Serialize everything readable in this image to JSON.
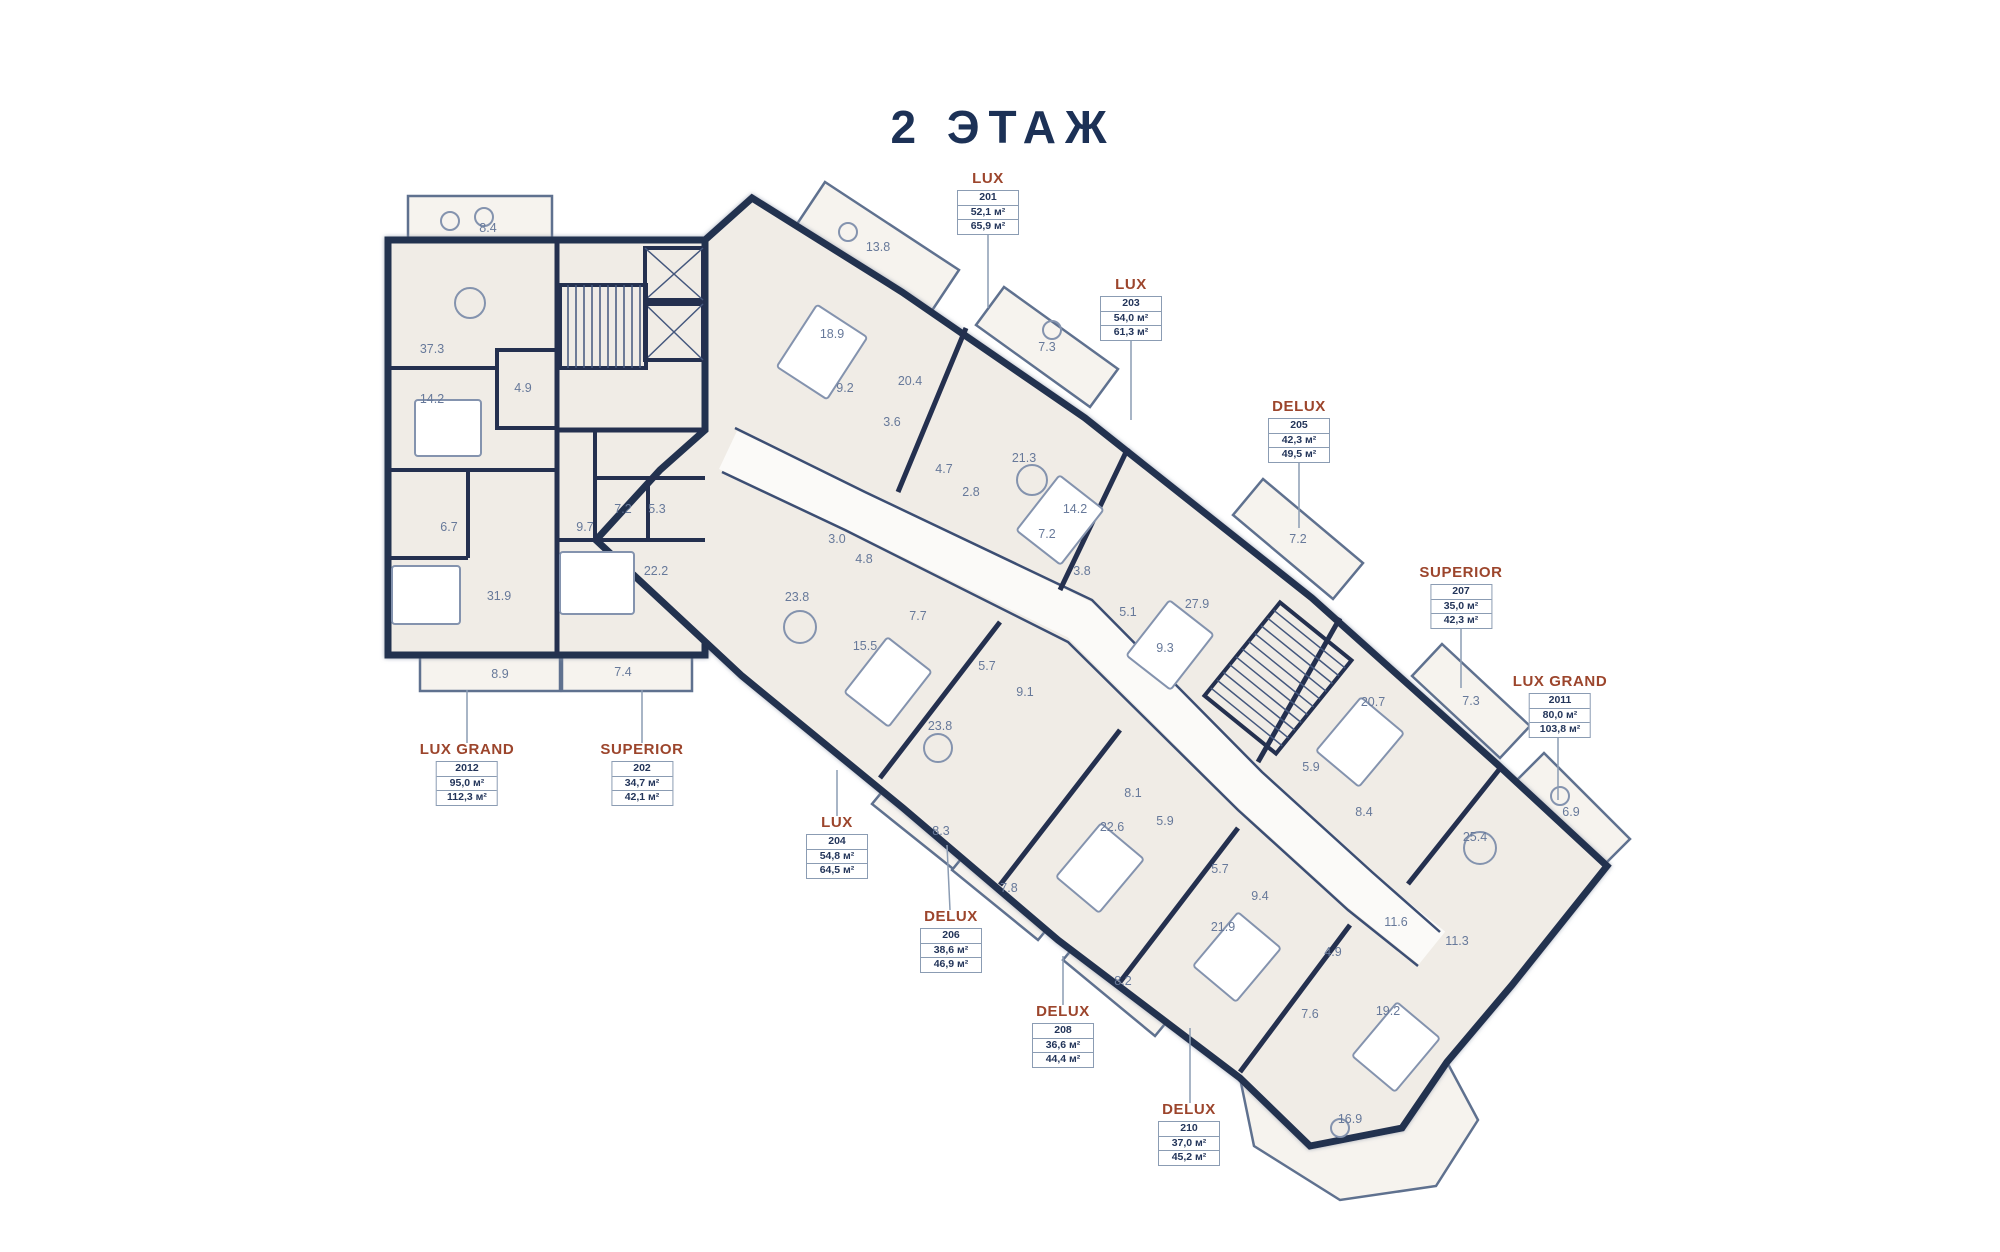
{
  "title": "2 ЭТАЖ",
  "colors": {
    "wall": "#24304f",
    "room_fill": "#f0ece6",
    "unit_type_accent": "#9c452c",
    "annotation": "#67799a",
    "box_border": "#8b9cb3",
    "box_text": "#23355a",
    "title_text": "#1c3156"
  },
  "units": [
    {
      "type": "LUX",
      "number": "201",
      "area1": "52,1 м²",
      "area2": "65,9 м²",
      "x": 988,
      "y": 170,
      "leader": [
        988,
        228,
        988,
        308
      ]
    },
    {
      "type": "LUX",
      "number": "203",
      "area1": "54,0 м²",
      "area2": "61,3 м²",
      "x": 1131,
      "y": 276,
      "leader": [
        1131,
        334,
        1131,
        420
      ]
    },
    {
      "type": "DELUX",
      "number": "205",
      "area1": "42,3 м²",
      "area2": "49,5 м²",
      "x": 1299,
      "y": 398,
      "leader": [
        1299,
        456,
        1299,
        528
      ]
    },
    {
      "type": "SUPERIOR",
      "number": "207",
      "area1": "35,0 м²",
      "area2": "42,3 м²",
      "x": 1461,
      "y": 564,
      "leader": [
        1461,
        622,
        1461,
        688
      ]
    },
    {
      "type": "LUX GRAND",
      "number": "2011",
      "area1": "80,0 м²",
      "area2": "103,8 м²",
      "x": 1560,
      "y": 673,
      "leader": [
        1558,
        731,
        1558,
        800
      ]
    },
    {
      "type": "LUX GRAND",
      "number": "2012",
      "area1": "95,0 м²",
      "area2": "112,3 м²",
      "x": 467,
      "y": 741,
      "leader": [
        467,
        690,
        467,
        743
      ]
    },
    {
      "type": "SUPERIOR",
      "number": "202",
      "area1": "34,7 м²",
      "area2": "42,1 м²",
      "x": 642,
      "y": 741,
      "leader": [
        642,
        690,
        642,
        743
      ]
    },
    {
      "type": "LUX",
      "number": "204",
      "area1": "54,8 м²",
      "area2": "64,5 м²",
      "x": 837,
      "y": 814,
      "leader": [
        837,
        770,
        837,
        816
      ]
    },
    {
      "type": "DELUX",
      "number": "206",
      "area1": "38,6 м²",
      "area2": "46,9 м²",
      "x": 951,
      "y": 908,
      "leader": [
        947,
        845,
        950,
        910
      ]
    },
    {
      "type": "DELUX",
      "number": "208",
      "area1": "36,6 м²",
      "area2": "44,4 м²",
      "x": 1063,
      "y": 1003,
      "leader": [
        1063,
        956,
        1063,
        1005
      ]
    },
    {
      "type": "DELUX",
      "number": "210",
      "area1": "37,0 м²",
      "area2": "45,2 м²",
      "x": 1189,
      "y": 1101,
      "leader": [
        1190,
        1028,
        1190,
        1103
      ]
    }
  ],
  "room_areas": [
    {
      "v": "8.4",
      "x": 488,
      "y": 228
    },
    {
      "v": "37.3",
      "x": 432,
      "y": 349
    },
    {
      "v": "14.2",
      "x": 432,
      "y": 399
    },
    {
      "v": "4.9",
      "x": 523,
      "y": 388
    },
    {
      "v": "6.7",
      "x": 449,
      "y": 527
    },
    {
      "v": "31.9",
      "x": 499,
      "y": 596
    },
    {
      "v": "8.9",
      "x": 500,
      "y": 674
    },
    {
      "v": "7.2",
      "x": 623,
      "y": 509
    },
    {
      "v": "5.3",
      "x": 657,
      "y": 509
    },
    {
      "v": "22.2",
      "x": 656,
      "y": 571
    },
    {
      "v": "7.4",
      "x": 623,
      "y": 672
    },
    {
      "v": "9.7",
      "x": 585,
      "y": 527
    },
    {
      "v": "13.8",
      "x": 878,
      "y": 247
    },
    {
      "v": "18.9",
      "x": 832,
      "y": 334
    },
    {
      "v": "9.2",
      "x": 845,
      "y": 388
    },
    {
      "v": "3.6",
      "x": 892,
      "y": 422
    },
    {
      "v": "20.4",
      "x": 910,
      "y": 381
    },
    {
      "v": "7.3",
      "x": 1047,
      "y": 347
    },
    {
      "v": "21.3",
      "x": 1024,
      "y": 458
    },
    {
      "v": "14.2",
      "x": 1075,
      "y": 509
    },
    {
      "v": "4.7",
      "x": 944,
      "y": 469
    },
    {
      "v": "2.8",
      "x": 971,
      "y": 492
    },
    {
      "v": "7.2",
      "x": 1047,
      "y": 534
    },
    {
      "v": "3.8",
      "x": 1082,
      "y": 571
    },
    {
      "v": "5.1",
      "x": 1128,
      "y": 612
    },
    {
      "v": "9.3",
      "x": 1165,
      "y": 648
    },
    {
      "v": "27.9",
      "x": 1197,
      "y": 604
    },
    {
      "v": "7.2",
      "x": 1298,
      "y": 539
    },
    {
      "v": "20.7",
      "x": 1373,
      "y": 702
    },
    {
      "v": "7.3",
      "x": 1471,
      "y": 701
    },
    {
      "v": "5.9",
      "x": 1311,
      "y": 767
    },
    {
      "v": "8.4",
      "x": 1364,
      "y": 812
    },
    {
      "v": "25.4",
      "x": 1475,
      "y": 837
    },
    {
      "v": "6.9",
      "x": 1571,
      "y": 812
    },
    {
      "v": "3.0",
      "x": 837,
      "y": 539
    },
    {
      "v": "4.8",
      "x": 864,
      "y": 559
    },
    {
      "v": "23.8",
      "x": 797,
      "y": 597
    },
    {
      "v": "7.7",
      "x": 918,
      "y": 616
    },
    {
      "v": "15.5",
      "x": 865,
      "y": 646
    },
    {
      "v": "5.7",
      "x": 987,
      "y": 666
    },
    {
      "v": "9.1",
      "x": 1025,
      "y": 692
    },
    {
      "v": "23.8",
      "x": 940,
      "y": 726
    },
    {
      "v": "8.3",
      "x": 941,
      "y": 831
    },
    {
      "v": "7.8",
      "x": 1009,
      "y": 888
    },
    {
      "v": "8.1",
      "x": 1133,
      "y": 793
    },
    {
      "v": "5.9",
      "x": 1165,
      "y": 821
    },
    {
      "v": "22.6",
      "x": 1112,
      "y": 827
    },
    {
      "v": "5.7",
      "x": 1220,
      "y": 869
    },
    {
      "v": "9.4",
      "x": 1260,
      "y": 896
    },
    {
      "v": "21.9",
      "x": 1223,
      "y": 927
    },
    {
      "v": "8.2",
      "x": 1123,
      "y": 981
    },
    {
      "v": "4.9",
      "x": 1333,
      "y": 952
    },
    {
      "v": "11.6",
      "x": 1396,
      "y": 922
    },
    {
      "v": "11.3",
      "x": 1457,
      "y": 941
    },
    {
      "v": "7.6",
      "x": 1310,
      "y": 1014
    },
    {
      "v": "19.2",
      "x": 1388,
      "y": 1011
    },
    {
      "v": "16.9",
      "x": 1350,
      "y": 1119
    }
  ]
}
